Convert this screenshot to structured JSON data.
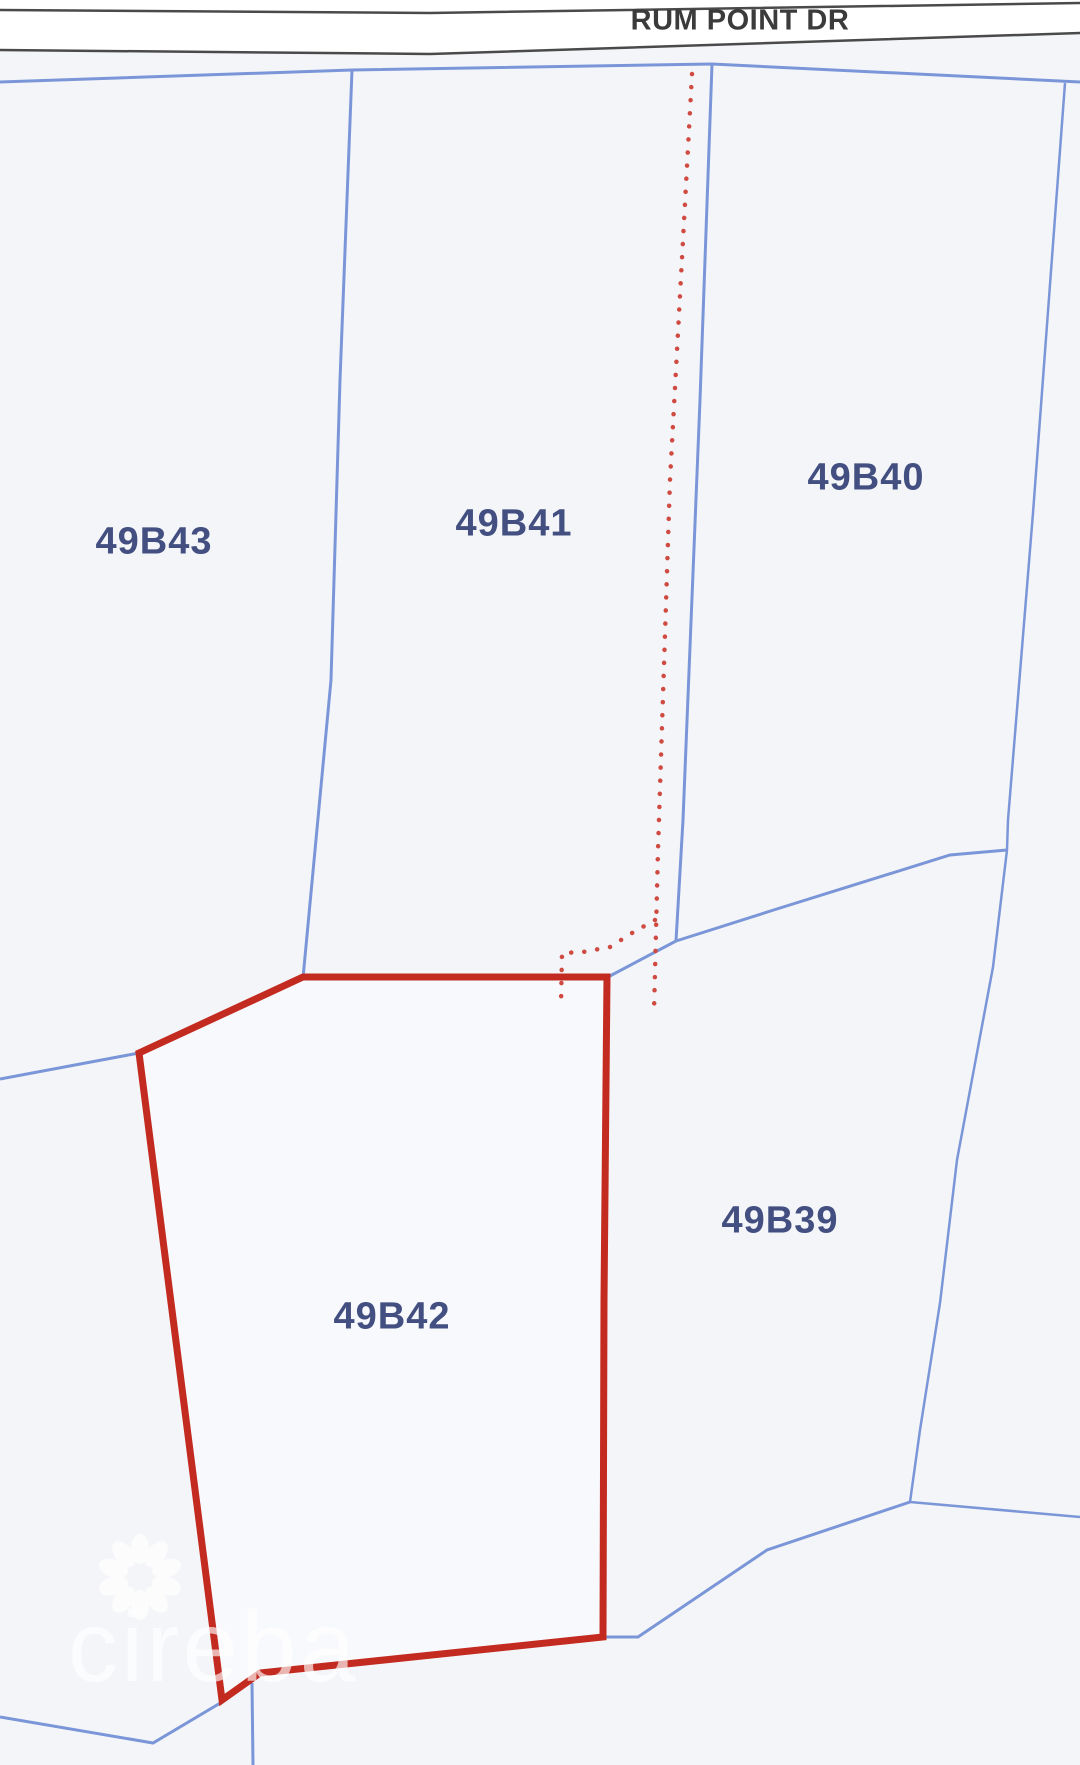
{
  "map": {
    "road": {
      "name": "RUM POINT DR"
    },
    "parcels": [
      {
        "id": "49B43",
        "highlighted": false
      },
      {
        "id": "49B41",
        "highlighted": false
      },
      {
        "id": "49B40",
        "highlighted": false
      },
      {
        "id": "49B39",
        "highlighted": false
      },
      {
        "id": "49B42",
        "highlighted": true
      }
    ],
    "highlighted_parcel": "49B42",
    "watermark": {
      "text": "cireba",
      "logo": "flower-icon"
    },
    "colors": {
      "background": "#f4f5f8",
      "road_fill": "#ffffff",
      "road_edge": "#4a4a4a",
      "road_text": "#3b3b3b",
      "boundary_line": "#7b96d8",
      "highlight_outline": "#c32a20",
      "highlight_fill": "#f8f9fc",
      "dotted_line": "#cf4a41",
      "label_text": "#424f80",
      "watermark": "#ffffff"
    }
  }
}
